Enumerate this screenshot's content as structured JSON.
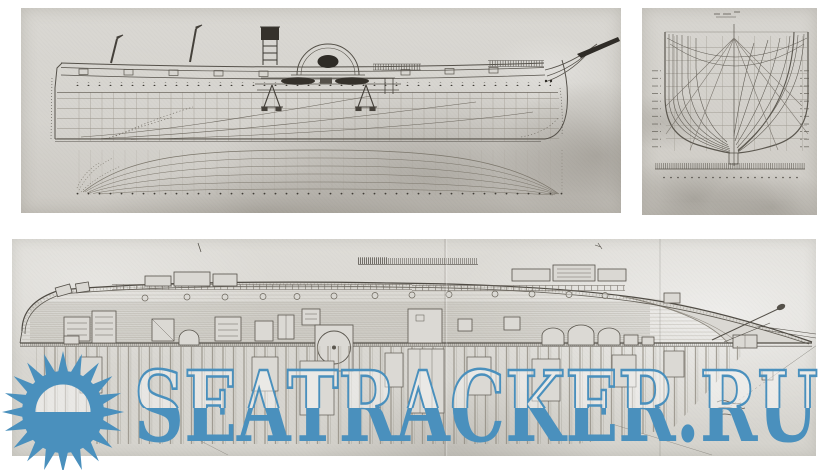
{
  "watermark": {
    "text": "SEATRACKER.RU",
    "logo": "sunburst",
    "color": "#4a90bd",
    "sun": {
      "cx": 63,
      "cy": 412,
      "outer": 61,
      "inner": 37,
      "rays": 20,
      "disc": 41,
      "dome": 27.5
    }
  },
  "colors": {
    "page_bg": "#ffffff",
    "paper": "#d7d5d0",
    "paper_dark": "#c9c6c0",
    "ink": "#57534b"
  },
  "panels": [
    {
      "id": "side-profile",
      "caption": "Side elevation (sheer plan) of a paddle steamer with half-breadth waterlines below"
    },
    {
      "id": "body-plan",
      "caption": "Body plan: nested hull cross sections with scale bar"
    },
    {
      "id": "deck-plan",
      "caption": "Deck plan: planked deck, hatches and transverse framing"
    }
  ]
}
